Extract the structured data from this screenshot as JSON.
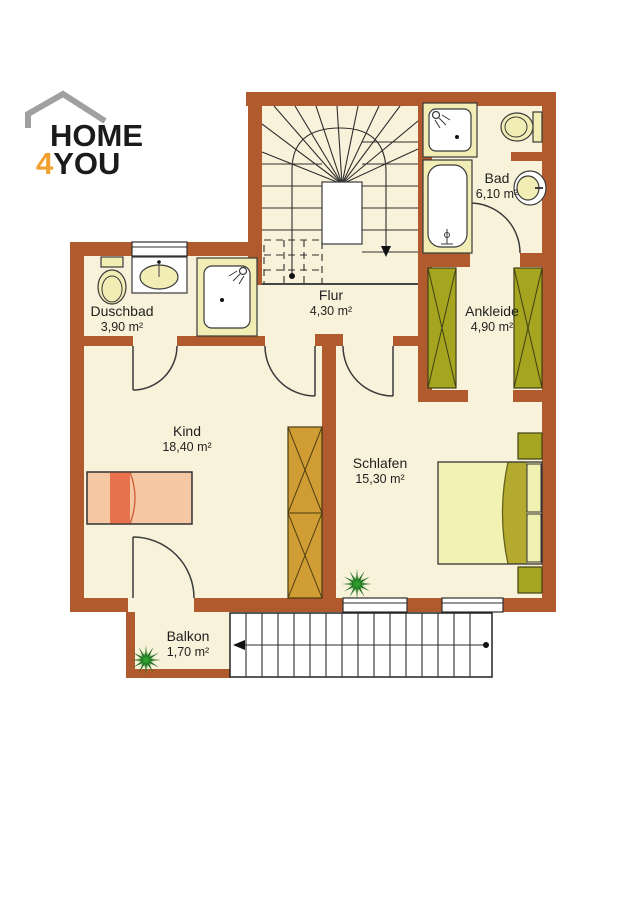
{
  "logo": {
    "word_top": "HOME",
    "digit": "4",
    "word_bottom": "YOU"
  },
  "rooms": [
    {
      "id": "duschbad",
      "name": "Duschbad",
      "area": "3,90 m²"
    },
    {
      "id": "flur",
      "name": "Flur",
      "area": "4,30 m²"
    },
    {
      "id": "bad",
      "name": "Bad",
      "area": "6,10 m²"
    },
    {
      "id": "ankleide",
      "name": "Ankleide",
      "area": "4,90 m²"
    },
    {
      "id": "kind",
      "name": "Kind",
      "area": "18,40 m²"
    },
    {
      "id": "schlafen",
      "name": "Schlafen",
      "area": "15,30 m²"
    },
    {
      "id": "balkon",
      "name": "Balkon",
      "area": "1,70 m²"
    }
  ],
  "colors": {
    "wall": "#b05a2d",
    "floor": "#f9f2da",
    "fixture": "#f1edb5",
    "olive": "#a6a51f",
    "gold": "#cf9d33",
    "bed_kind": "#f6c7a3",
    "bed_kind_stripe": "#e8724d",
    "bed_schlafen": "#f2f2b2",
    "bed_schlafen_band": "#b3aa2f",
    "pillow": "#f0f0b0",
    "plant_dark": "#1d6b1d",
    "plant_light": "#2f9e2f",
    "logo_accent": "#f2a12e",
    "logo_house": "#a0a0a0",
    "ink": "#1f1f1f"
  }
}
